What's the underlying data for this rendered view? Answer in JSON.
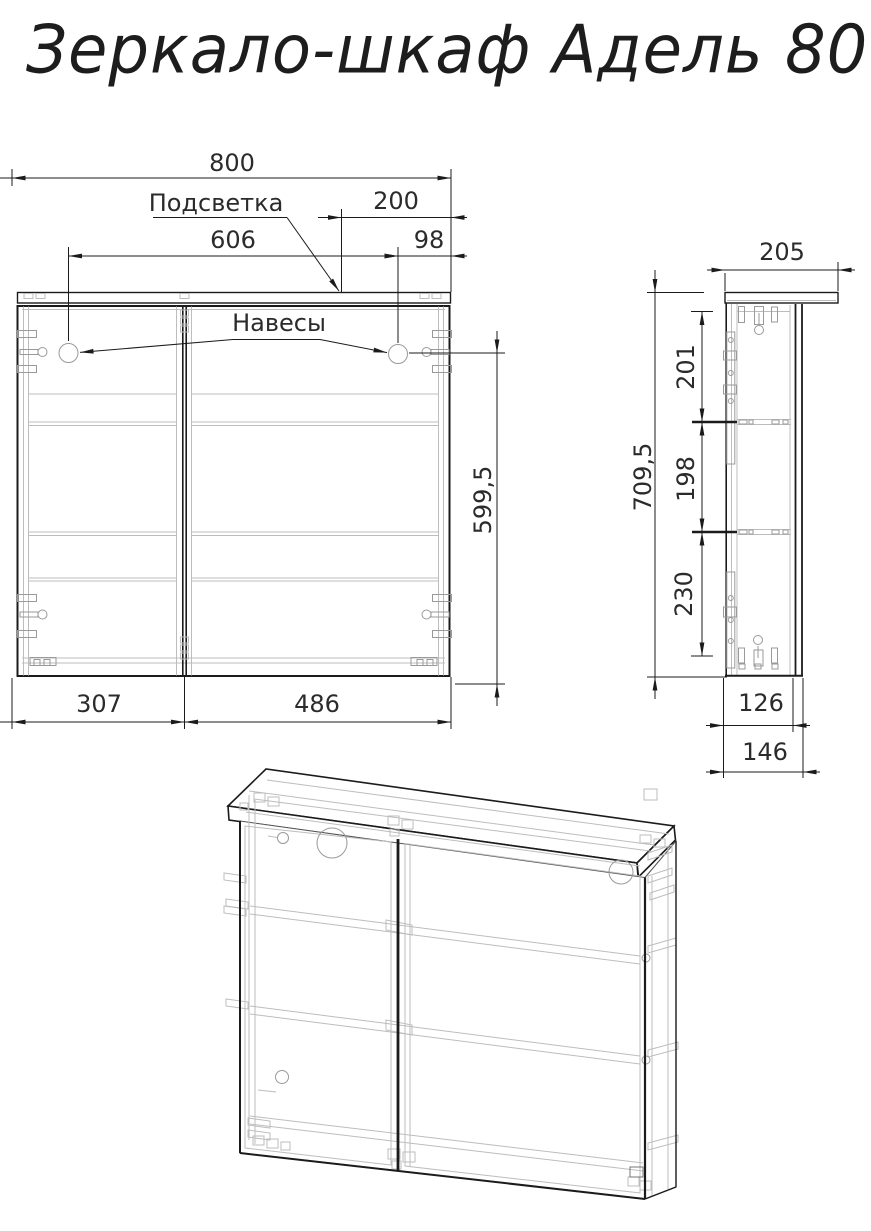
{
  "title": "Зеркало-шкаф Адель 80",
  "front_view": {
    "dims": {
      "total_width": "800",
      "backlight_label": "Подсветка",
      "backlight_width": "200",
      "hanger_spacing": "606",
      "hanger_offset": "98",
      "hangers_label": "Навесы",
      "hanger_to_bottom": "599,5",
      "left_door_width": "307",
      "right_door_width": "486"
    }
  },
  "side_view": {
    "dims": {
      "total_depth": "205",
      "upper_section": "201",
      "middle_section": "198",
      "lower_section": "230",
      "total_height": "709,5",
      "body_depth": "126",
      "overall_depth": "146"
    }
  },
  "colors": {
    "line": "#1b1b1b",
    "hidden_line": "#bdbdbd",
    "background": "#ffffff"
  }
}
